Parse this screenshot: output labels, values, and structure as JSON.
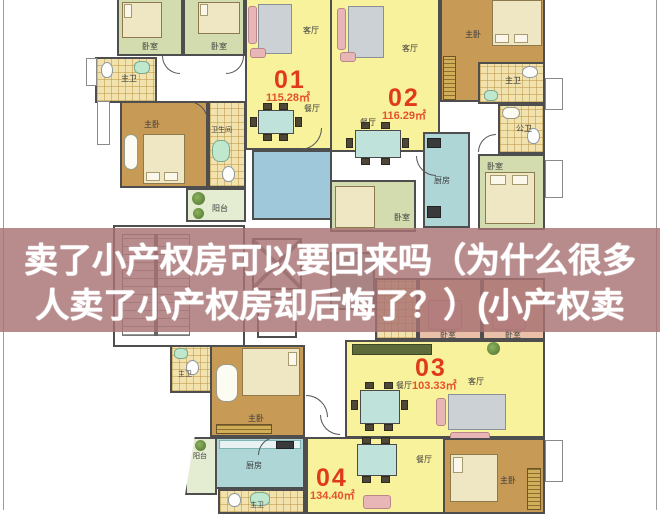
{
  "overlay": {
    "line1": "卖了小产权房可以要回来吗（为什么很多",
    "line2": "人卖了小产权房却后悔了？）(小产权卖",
    "band_color": "#a87273",
    "text_color": "#ffffff"
  },
  "rooms": {
    "living": "客厅",
    "dining": "餐厅",
    "bedroom": "卧室",
    "master_bedroom": "主卧",
    "master_bath": "主卫",
    "public_bath": "公卫",
    "bathroom": "卫生间",
    "kitchen": "厨房",
    "balcony": "阳台"
  },
  "units": {
    "u01": {
      "no": "01",
      "area": "115.28㎡"
    },
    "u02": {
      "no": "02",
      "area": "116.29㎡"
    },
    "u03": {
      "no": "03",
      "area": "103.33㎡"
    },
    "u04": {
      "no": "04",
      "area": "134.40㎡"
    }
  },
  "colors": {
    "living_yellow": "#f8f29c",
    "master_tan": "#c79a55",
    "bedroom_green": "#d2dcae",
    "kitchen_teal": "#aed6d6",
    "bath_hatch": "#f1e2ae",
    "blue_room": "#9fc8da",
    "unit_number_red": "#e03a1c",
    "wall_gray": "#4e4e4e"
  }
}
